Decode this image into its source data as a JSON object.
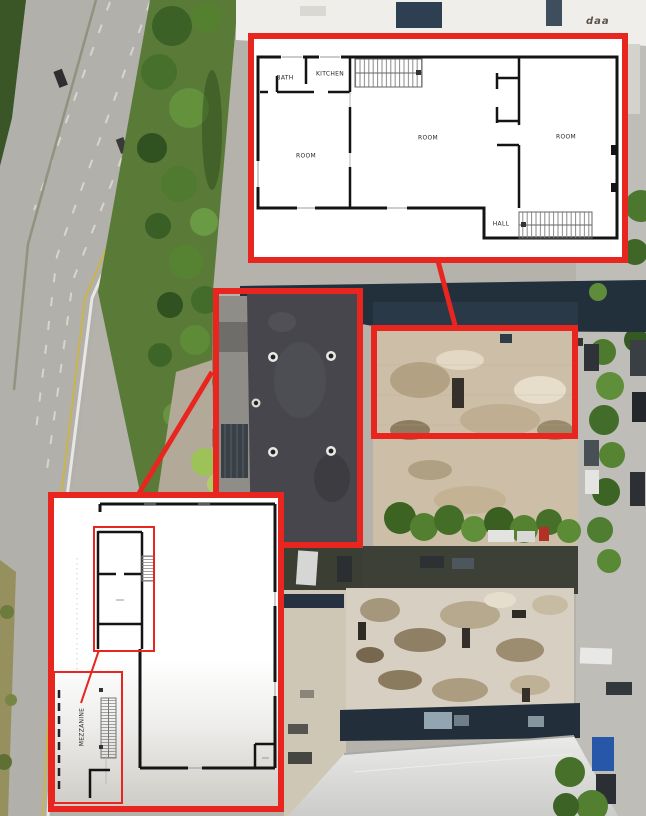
{
  "colors": {
    "annotation_red": "#e8251e",
    "plan_background": "#ffffff",
    "wall_color": "#141414"
  },
  "photo": {
    "roof_text": "daa"
  },
  "upper_plan": {
    "bath": "BATH",
    "kitchen": "KITCHEN",
    "room_left": "ROOM",
    "room_center": "ROOM",
    "room_right": "ROOM",
    "hall": "HALL"
  },
  "lower_plan": {
    "mezzanine": "MEZZANINE"
  }
}
